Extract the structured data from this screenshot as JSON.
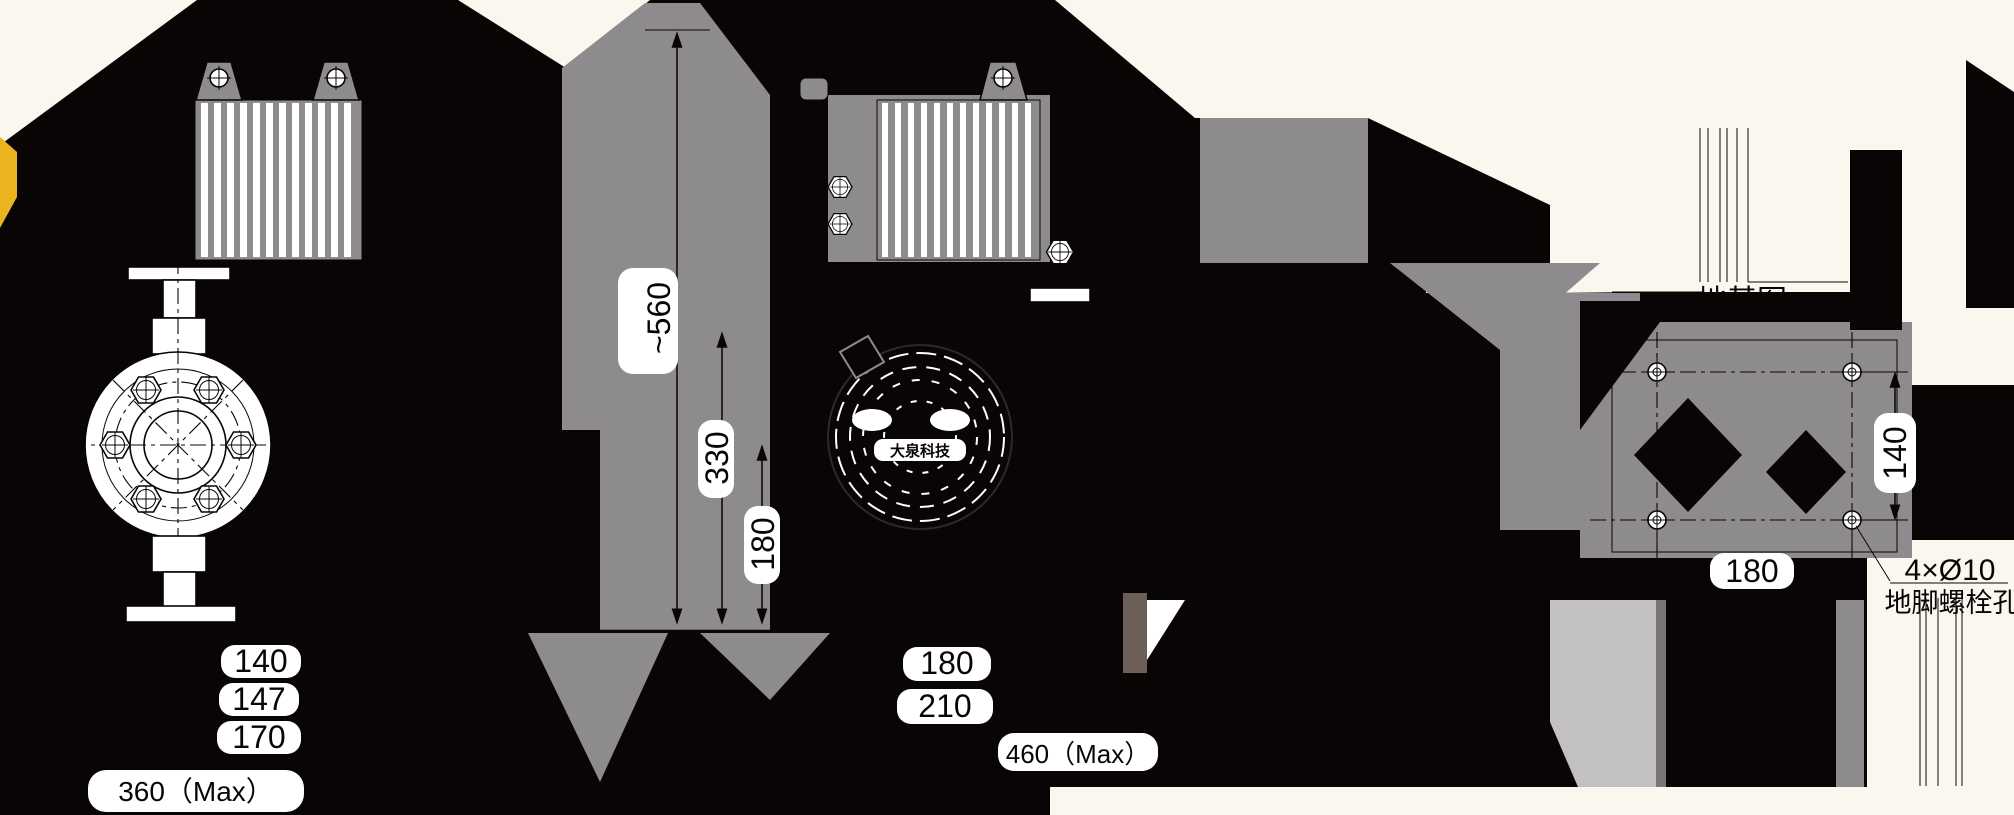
{
  "drawing": {
    "brand_label": "大泉科技",
    "front_view": {
      "dim_flange": "140",
      "dim_bolt_spacing": "147",
      "dim_base": "170",
      "dim_overall_width": "360（Max）"
    },
    "side_view": {
      "dim_overall_height": "~560",
      "dim_mid_height": "330",
      "dim_low_height": "180",
      "dim_depth_inner": "180",
      "dim_depth_base": "210",
      "dim_overall_depth": "460（Max）"
    },
    "foundation_view": {
      "title": "地基图",
      "dim_width": "180",
      "dim_height": "140",
      "bolt_note_spec": "4×Ø10",
      "bolt_note_label": "地脚螺栓孔"
    },
    "colors": {
      "background": "#FAF7EF",
      "ink": "#0A0505",
      "gray": "#8D8B8E",
      "light_gray": "#C3C0C3",
      "dark_gray": "#7A7678",
      "brown_gray": "#6B5F58",
      "accent_yellow": "#EAB31F",
      "white": "#FFFFFF"
    }
  }
}
